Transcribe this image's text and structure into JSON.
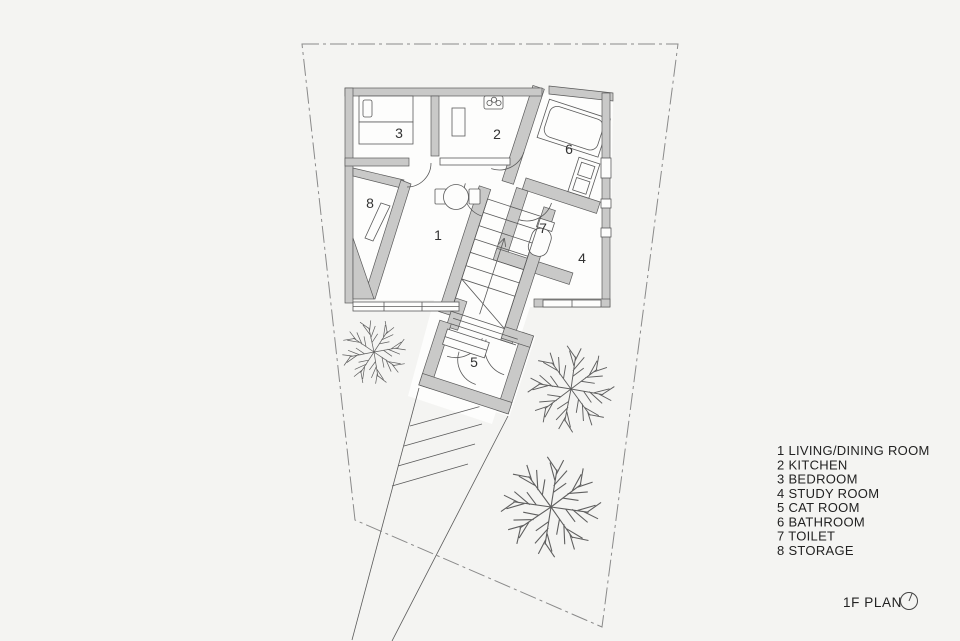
{
  "page": {
    "background": "#f4f4f2"
  },
  "colors": {
    "background": "#f4f4f2",
    "interior": "#fdfdfc",
    "wall_fill": "#c9c9c8",
    "wall_stroke": "#5a5a5a",
    "line": "#5a5a5a",
    "boundary": "#8a8a8a",
    "text": "#222222"
  },
  "plan": {
    "title": "1F PLAN",
    "north_icon": "north-indicator",
    "floor": "1F"
  },
  "rooms": [
    {
      "number": "1",
      "name": "LIVING/DINING ROOM",
      "label": "1 LIVING/DINING ROOM"
    },
    {
      "number": "2",
      "name": "KITCHEN",
      "label": "2 KITCHEN"
    },
    {
      "number": "3",
      "name": "BEDROOM",
      "label": "3 BEDROOM"
    },
    {
      "number": "4",
      "name": "STUDY ROOM",
      "label": "4 STUDY ROOM"
    },
    {
      "number": "5",
      "name": "CAT ROOM",
      "label": "5 CAT ROOM"
    },
    {
      "number": "6",
      "name": "BATHROOM",
      "label": "6 BATHROOM"
    },
    {
      "number": "7",
      "name": "TOILET",
      "label": "7 TOILET"
    },
    {
      "number": "8",
      "name": "STORAGE",
      "label": "8 STORAGE"
    }
  ]
}
